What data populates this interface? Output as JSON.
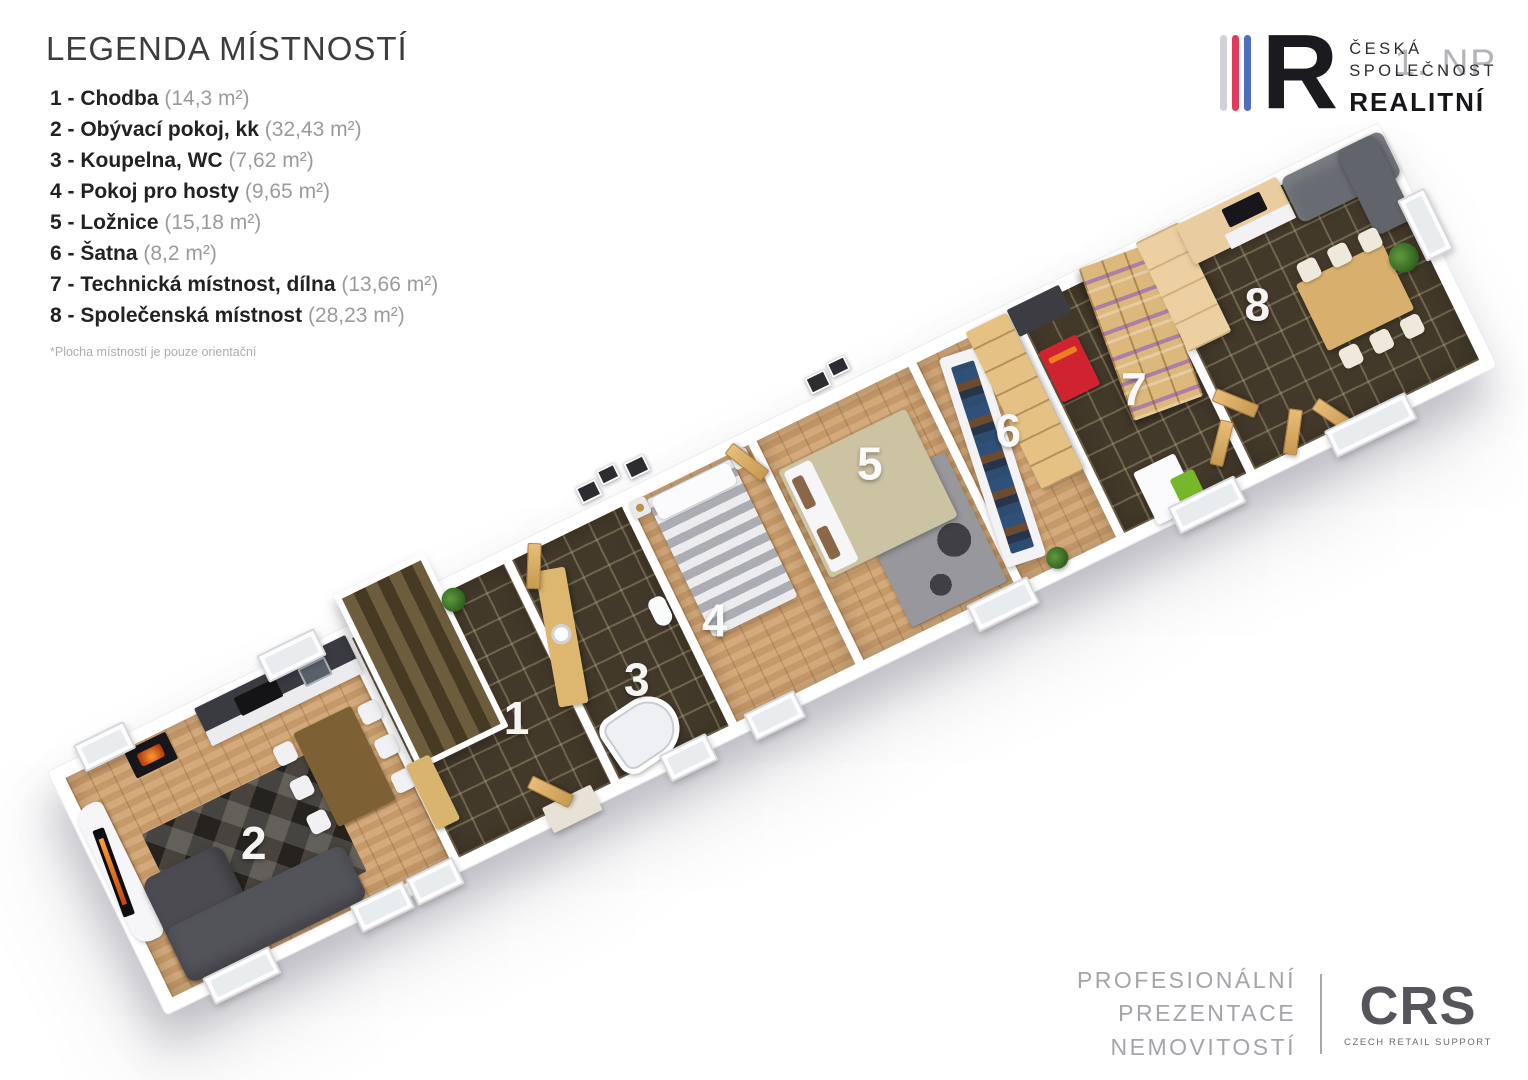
{
  "legend": {
    "title": "LEGENDA MÍSTNOSTÍ",
    "items": [
      {
        "label": "1 - Chodba",
        "area": "(14,3 m²)"
      },
      {
        "label": "2 - Obývací pokoj, kk",
        "area": "(32,43 m²)"
      },
      {
        "label": "3 - Koupelna, WC",
        "area": "(7,62 m²)"
      },
      {
        "label": "4 - Pokoj pro hosty",
        "area": "(9,65 m²)"
      },
      {
        "label": "5 - Ložnice",
        "area": "(15,18 m²)"
      },
      {
        "label": "6 - Šatna",
        "area": "(8,2 m²)"
      },
      {
        "label": "7 - Technická místnost, dílna",
        "area": "(13,66 m²)"
      },
      {
        "label": "8 - Společenská místnost",
        "area": "(28,23 m²)"
      }
    ],
    "footnote": "*Plocha místností je pouze orientační"
  },
  "brand": {
    "monogram": "R",
    "line1": "ČESKÁ",
    "line2": "SPOLEČNOST",
    "line3": "REALITNÍ",
    "floor_label": "1. NP",
    "bar_colors": [
      "#d2d2d6",
      "#e23a5c",
      "#4f6fbe"
    ]
  },
  "floorplan": {
    "rooms": [
      {
        "number": "2"
      },
      {
        "number": "1"
      },
      {
        "number": "3"
      },
      {
        "number": "4"
      },
      {
        "number": "5"
      },
      {
        "number": "6"
      },
      {
        "number": "7"
      },
      {
        "number": "8"
      }
    ],
    "colors": {
      "wood_floor": "#cfa271",
      "dark_tile": "#43392a",
      "wall": "#ffffff"
    }
  },
  "footer": {
    "lines": [
      "PROFESIONÁLNÍ",
      "PREZENTACE",
      "NEMOVITOSTÍ"
    ],
    "logo_text": "CRS",
    "logo_subtext": "CZECH RETAIL SUPPORT"
  }
}
